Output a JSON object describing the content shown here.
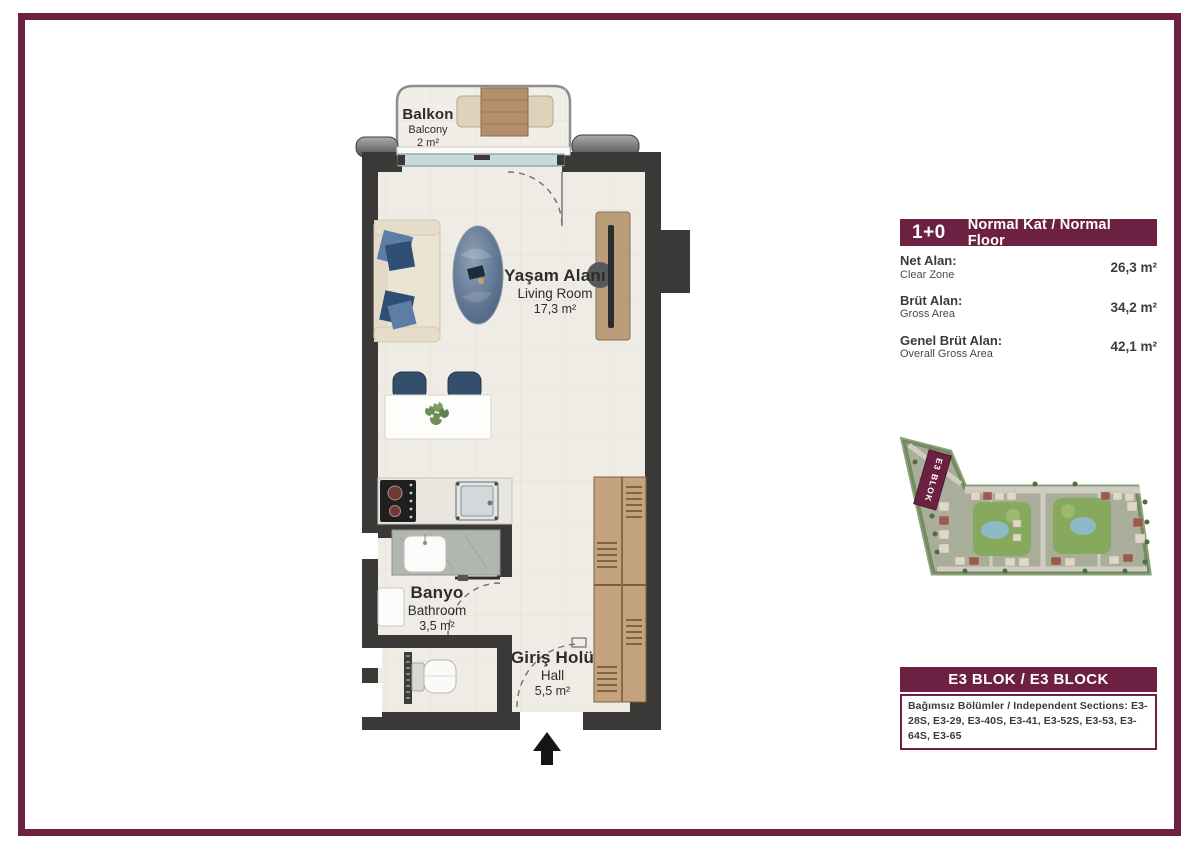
{
  "colors": {
    "maroon": "#6d2142",
    "wall": "#3a3938",
    "floor": "#efece5",
    "glass": "#c6dbdd",
    "wood": "#b5946f",
    "navy": "#32506c"
  },
  "plan": {
    "balcony": {
      "tr": "Balkon",
      "en": "Balcony",
      "area": "2 m²"
    },
    "living": {
      "tr": "Yaşam Alanı",
      "en": "Living Room",
      "area": "17,3 m²"
    },
    "bathroom": {
      "tr": "Banyo",
      "en": "Bathroom",
      "area": "3,5 m²"
    },
    "hall": {
      "tr": "Giriş Holü",
      "en": "Hall",
      "area": "5,5 m²"
    }
  },
  "info_panel": {
    "unit_type": "1+0",
    "floor_label": "Normal Kat / Normal Floor",
    "rows": [
      {
        "tr": "Net Alan:",
        "en": "Clear Zone",
        "value": "26,3 m²"
      },
      {
        "tr": "Brüt Alan:",
        "en": "Gross Area",
        "value": "34,2 m²"
      },
      {
        "tr": "Genel Brüt Alan:",
        "en": "Overall Gross Area",
        "value": "42,1 m²"
      }
    ]
  },
  "site_plan": {
    "block_label": "E3 BLOK"
  },
  "block_info": {
    "title": "E3 BLOK / E3 BLOCK",
    "sections": "Bağımsız Bölümler / Independent Sections: E3-28S, E3-29, E3-40S, E3-41, E3-52S, E3-53, E3-64S, E3-65"
  }
}
